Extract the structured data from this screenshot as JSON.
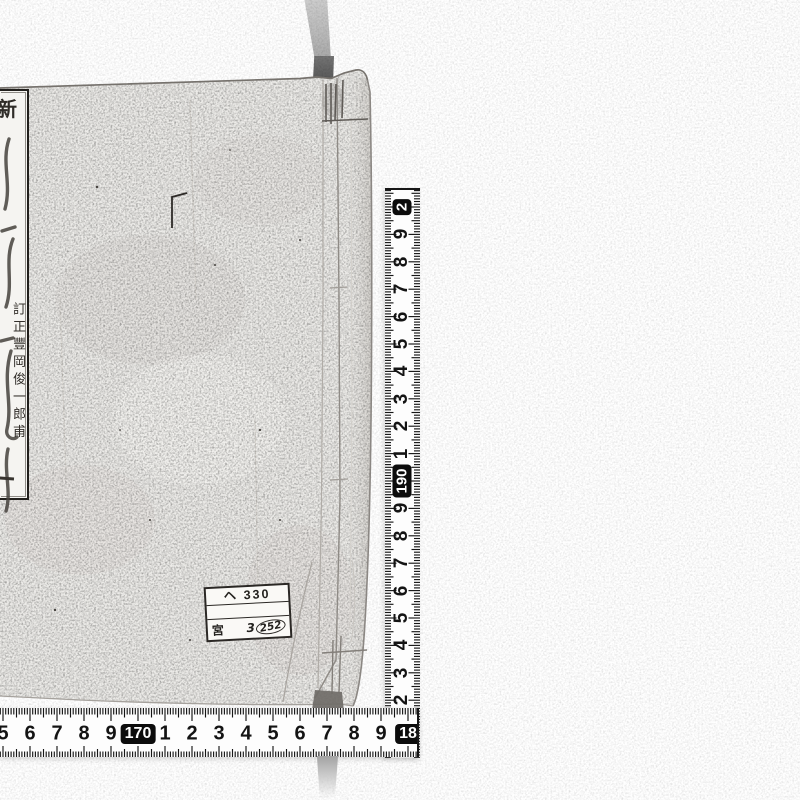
{
  "photo": {
    "book": {
      "title_slip": {
        "header_char": "新",
        "annotation_column": "訂正豐岡俊一郎甫",
        "partial_stroke_char": "一"
      },
      "shelf_label": {
        "row1": "ヘ 330",
        "row2": "",
        "row3_prefix": "宮",
        "row3_number_lead": "3",
        "row3_number_circled": "252"
      }
    },
    "vertical_ruler": {
      "orientation": "vertical",
      "unit": "cm",
      "numbers": [
        {
          "label": "2",
          "cm": 200,
          "boxed": true
        },
        {
          "label": "9",
          "cm": 199
        },
        {
          "label": "8",
          "cm": 198
        },
        {
          "label": "7",
          "cm": 197
        },
        {
          "label": "6",
          "cm": 196
        },
        {
          "label": "5",
          "cm": 195
        },
        {
          "label": "4",
          "cm": 194
        },
        {
          "label": "3",
          "cm": 193
        },
        {
          "label": "2",
          "cm": 192
        },
        {
          "label": "1",
          "cm": 191
        },
        {
          "label": "190",
          "cm": 190,
          "boxed": true
        },
        {
          "label": "9",
          "cm": 189
        },
        {
          "label": "8",
          "cm": 188
        },
        {
          "label": "7",
          "cm": 187
        },
        {
          "label": "6",
          "cm": 186
        },
        {
          "label": "5",
          "cm": 185
        },
        {
          "label": "4",
          "cm": 184
        },
        {
          "label": "3",
          "cm": 183
        },
        {
          "label": "2",
          "cm": 182
        }
      ]
    },
    "horizontal_ruler": {
      "orientation": "horizontal",
      "unit": "cm",
      "numbers": [
        {
          "label": "5",
          "cm": 165
        },
        {
          "label": "6",
          "cm": 166
        },
        {
          "label": "7",
          "cm": 167
        },
        {
          "label": "8",
          "cm": 168
        },
        {
          "label": "9",
          "cm": 169
        },
        {
          "label": "170",
          "cm": 170,
          "boxed": true
        },
        {
          "label": "1",
          "cm": 171
        },
        {
          "label": "2",
          "cm": 172
        },
        {
          "label": "3",
          "cm": 173
        },
        {
          "label": "4",
          "cm": 174
        },
        {
          "label": "5",
          "cm": 175
        },
        {
          "label": "6",
          "cm": 176
        },
        {
          "label": "7",
          "cm": 177
        },
        {
          "label": "8",
          "cm": 178
        },
        {
          "label": "9",
          "cm": 179
        },
        {
          "label": "18",
          "cm": 180,
          "boxed": true
        }
      ]
    },
    "colors": {
      "background": "#ffffff",
      "cover": "#ecebe8",
      "tape": "#fdfdfd",
      "ink": "#161616",
      "strap": "#9e9e9e",
      "label_border": "#2b2825"
    }
  }
}
